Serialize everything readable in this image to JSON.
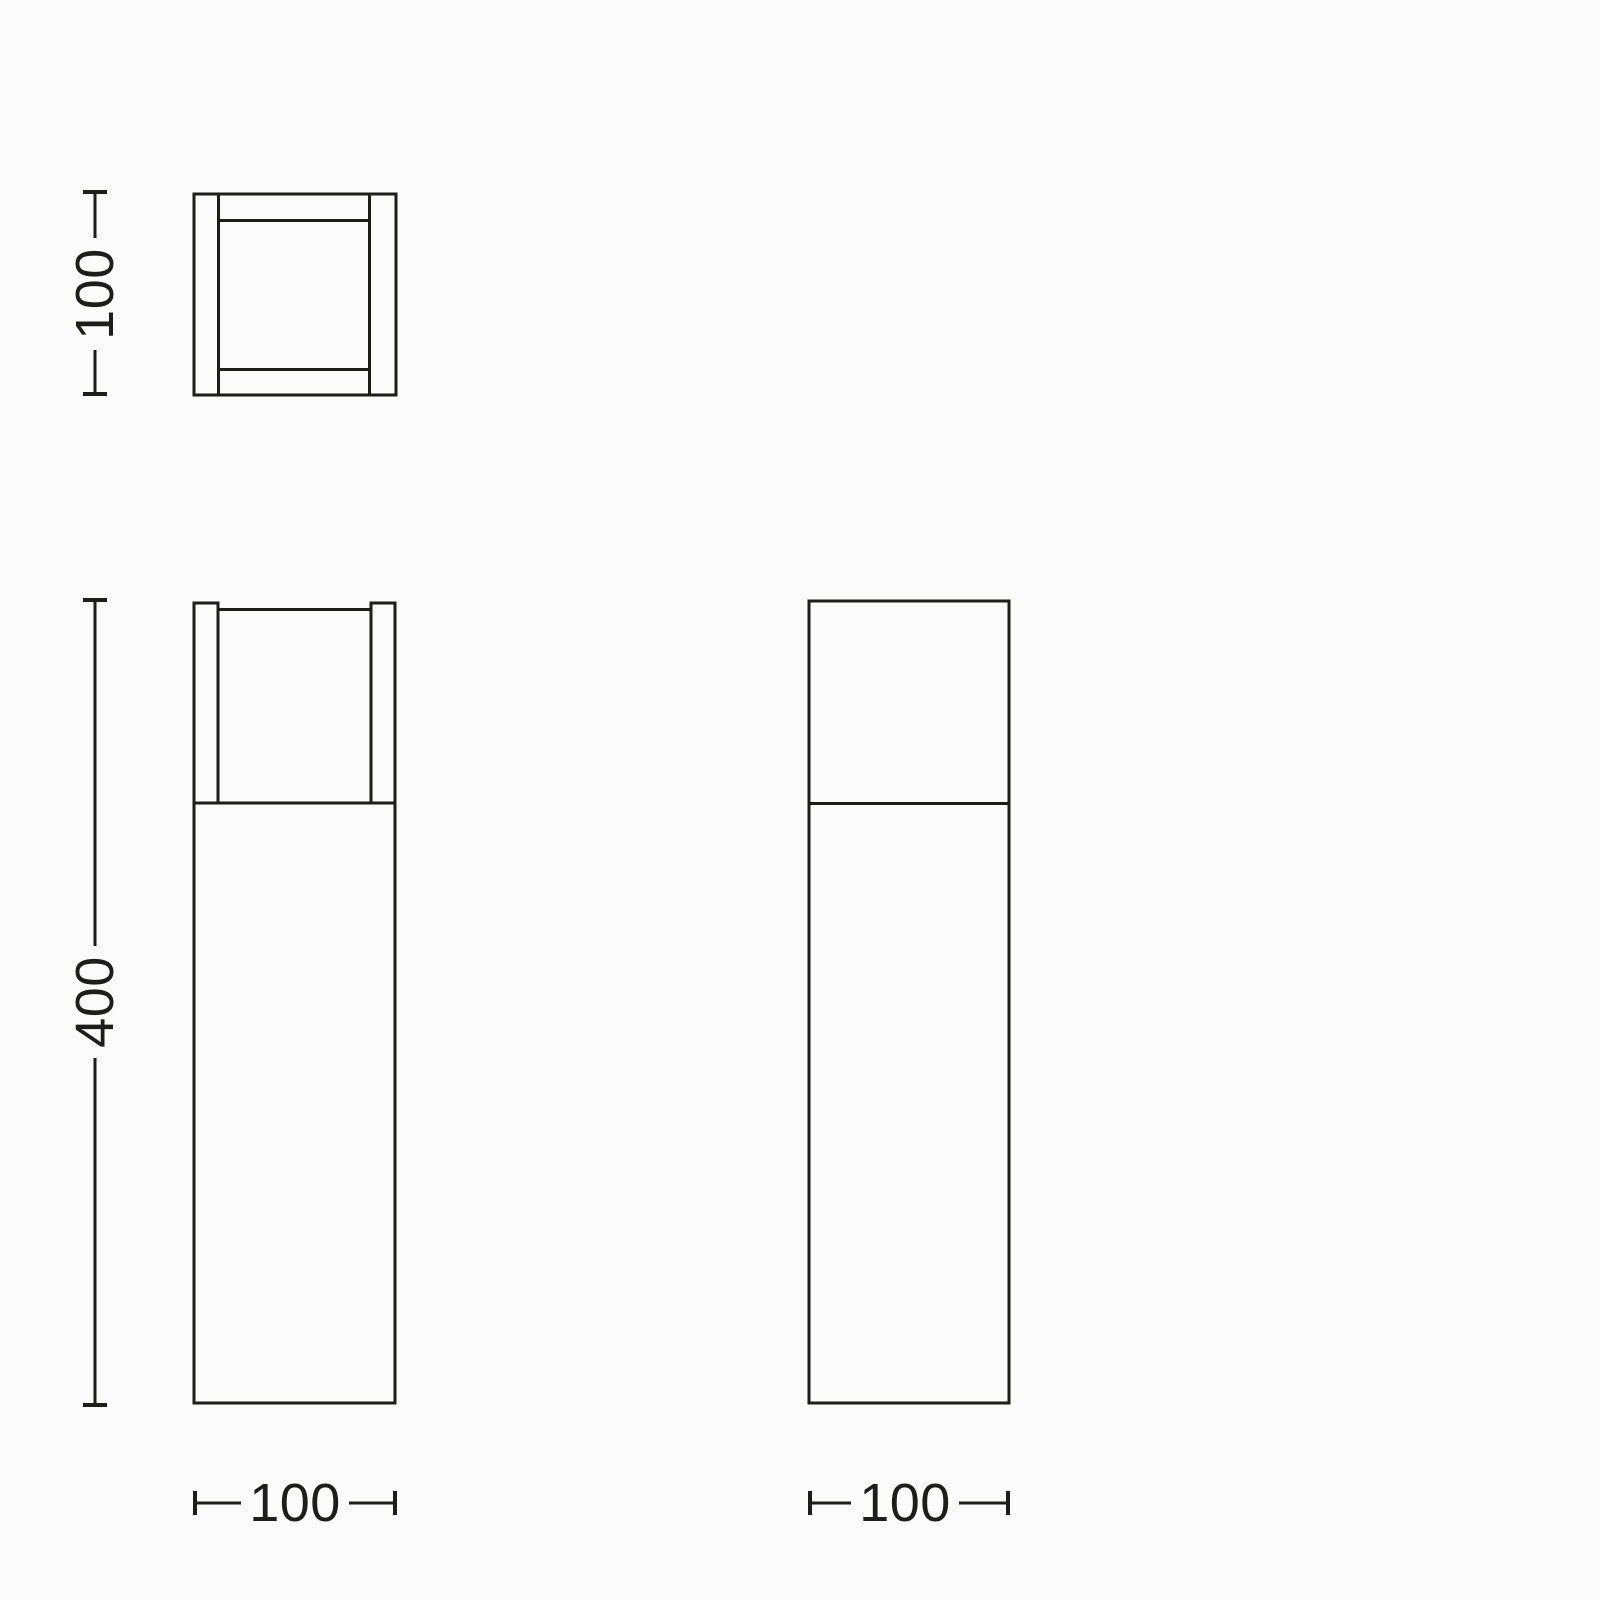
{
  "page": {
    "background_color": "#fbfbfb",
    "line_color": "#1d1d1b"
  },
  "diagram": {
    "kind": "technical-dimension-drawing",
    "subject": "square bollard luminaire, three orthographic views",
    "views": {
      "top_view": {
        "name": "plan view of square luminaire head",
        "height_dimension": "100"
      },
      "front_view": {
        "name": "front elevation with lamp head and post",
        "height_dimension": "400",
        "width_dimension": "100"
      },
      "side_view": {
        "name": "side elevation, plain head over post",
        "width_dimension": "100"
      }
    }
  }
}
